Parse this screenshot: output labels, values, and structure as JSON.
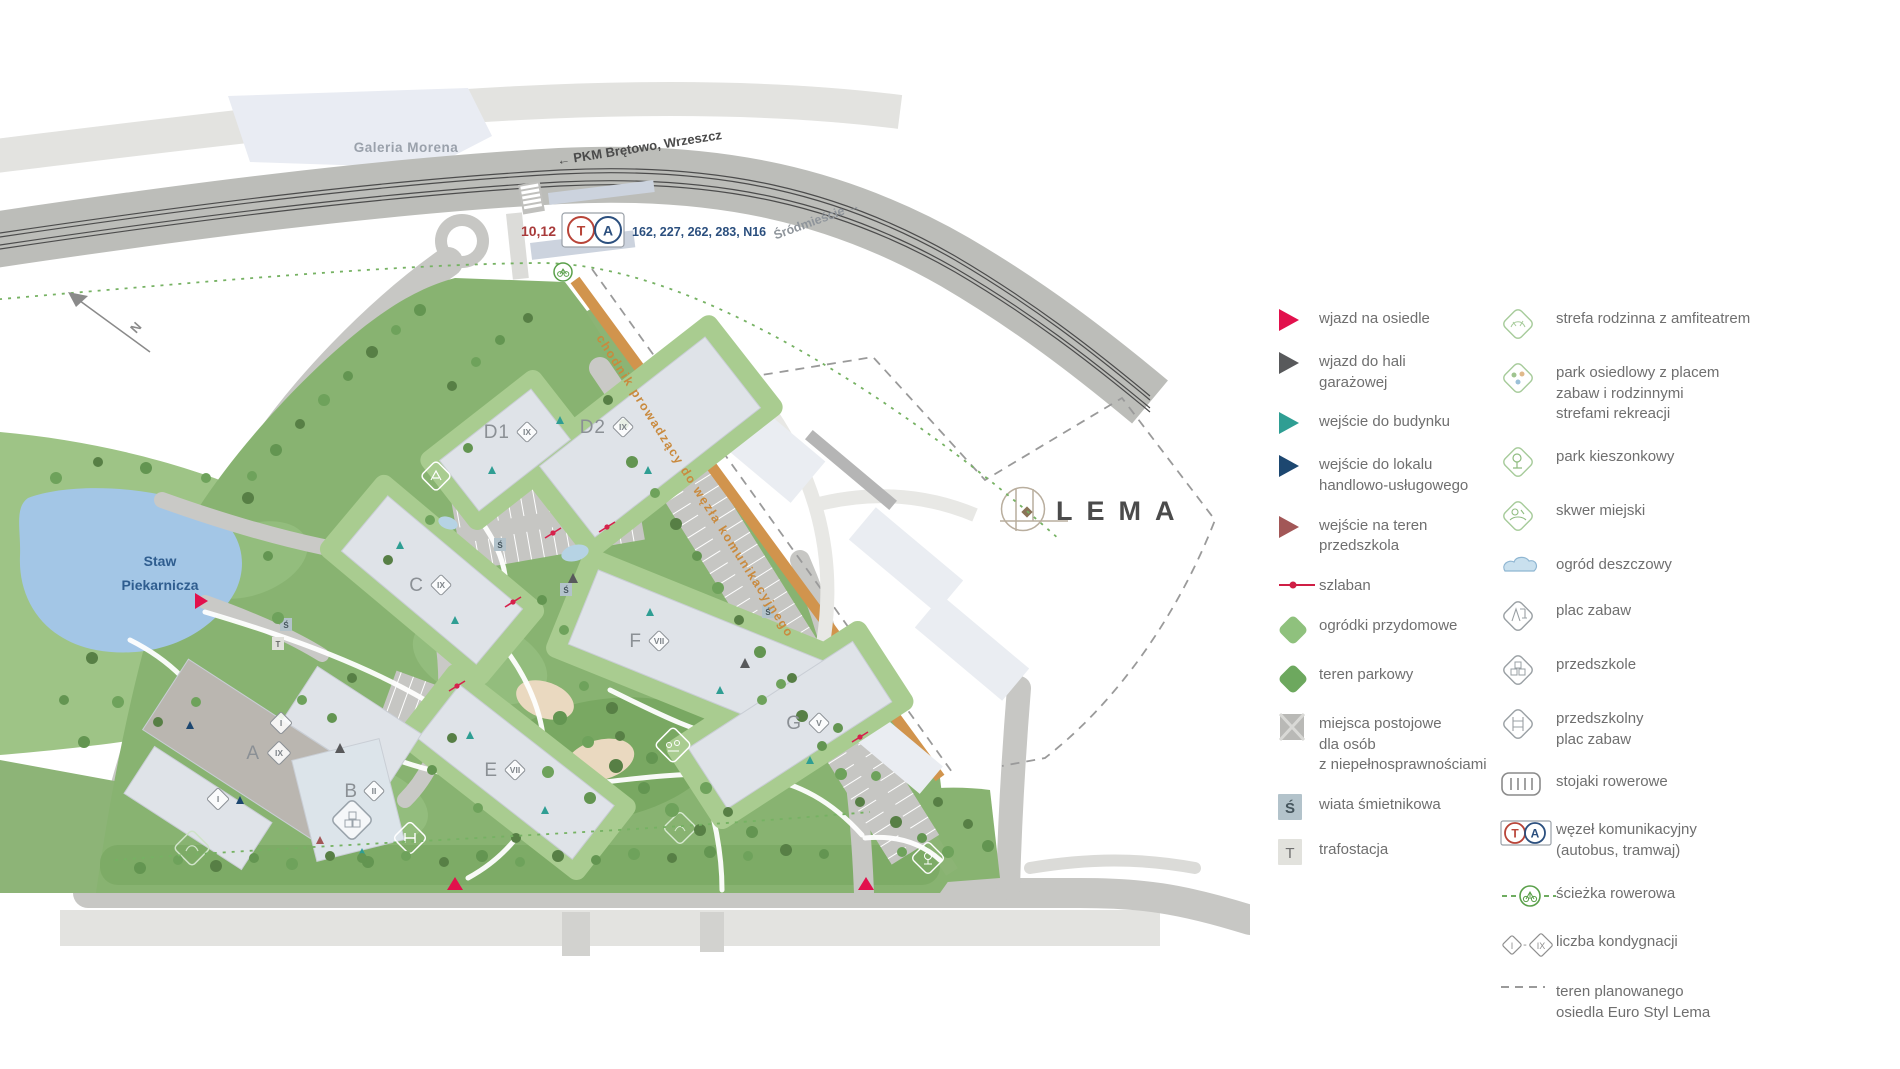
{
  "map": {
    "galeria_label": "Galeria Morena",
    "pkm_label": "← PKM Brętowo, Wrzeszcz",
    "srodmiescie_label": "Śródmieście →",
    "pond_label_1": "Staw",
    "pond_label_2": "Piekarnicza",
    "north_label": "N",
    "path_label": "chodnik prowadzący do węzła komunikacyjnego",
    "logo_text": "LEMA",
    "transit_badge": {
      "tram_lines": "10,12",
      "tram_letter": "T",
      "bus_letter": "A",
      "bus_lines": "162, 227, 262, 283, N16"
    },
    "buildings": [
      {
        "label": "D1",
        "floors": "IX"
      },
      {
        "label": "D2",
        "floors": "IX"
      },
      {
        "label": "C",
        "floors": "IX"
      },
      {
        "label": "F",
        "floors": "VII"
      },
      {
        "label": "G",
        "floors": "V"
      },
      {
        "label": "E",
        "floors": "VII"
      },
      {
        "label": "A",
        "floors": "IX"
      },
      {
        "label": "B",
        "floors": "II"
      }
    ],
    "wing_floor_label": "I",
    "shelter_letter": "Ś",
    "trafo_letter": "T"
  },
  "legend": {
    "column1": [
      {
        "icon": "entry-estate-arrow",
        "label": "wjazd na osiedle"
      },
      {
        "icon": "entry-garage-arrow",
        "label": "wjazd do hali\ngarażowej"
      },
      {
        "icon": "building-entrance-arrow",
        "label": "wejście do budynku"
      },
      {
        "icon": "retail-entrance-arrow",
        "label": "wejście do lokalu\nhandlowo-usługowego"
      },
      {
        "icon": "kindergarten-entrance-arrow",
        "label": "wejście na teren\nprzedszkola"
      },
      {
        "icon": "barrier",
        "label": "szlaban"
      },
      {
        "icon": "home-gardens",
        "label": "ogródki przydomowe"
      },
      {
        "icon": "park-area",
        "label": "teren parkowy"
      },
      {
        "icon": "disabled-parking",
        "label": "miejsca postojowe\ndla osób\nz niepełnosprawnościami"
      },
      {
        "icon": "waste-shelter",
        "label": "wiata śmietnikowa",
        "letter": "Ś"
      },
      {
        "icon": "transformer",
        "label": "trafostacja",
        "letter": "T"
      }
    ],
    "column2": [
      {
        "icon": "family-zone",
        "label": "strefa rodzinna z amfiteatrem"
      },
      {
        "icon": "estate-park",
        "label": "park osiedlowy z placem\nzabaw i rodzinnymi\nstrefami rekreacji"
      },
      {
        "icon": "pocket-park",
        "label": "park kieszonkowy"
      },
      {
        "icon": "city-square",
        "label": "skwer miejski"
      },
      {
        "icon": "rain-garden",
        "label": "ogród deszczowy"
      },
      {
        "icon": "playground",
        "label": "plac zabaw"
      },
      {
        "icon": "kindergarten",
        "label": "przedszkole"
      },
      {
        "icon": "kindergarten-playground",
        "label": "przedszkolny\nplac zabaw"
      },
      {
        "icon": "bike-racks",
        "label": "stojaki rowerowe"
      },
      {
        "icon": "transport-hub",
        "label": "węzeł komunikacyjny\n(autobus, tramwaj)",
        "tram_letter": "T",
        "bus_letter": "A"
      },
      {
        "icon": "bike-path",
        "label": "ścieżka rowerowa"
      },
      {
        "icon": "floors-count",
        "label": "liczba kondygnacji",
        "from": "I",
        "to": "IX"
      },
      {
        "icon": "planned-area",
        "label": "teren planowanego\nosiedla Euro Styl Lema"
      }
    ]
  },
  "colors": {
    "accent_red": "#e2104c",
    "teal": "#2f9e93",
    "navy": "#1d4770",
    "maroon": "#a25757",
    "dark_gray": "#58595b",
    "green_light": "#8fc17d",
    "green_dark": "#6da85e",
    "orange_path": "#d1944d",
    "pond_blue": "#a3c6e6"
  }
}
